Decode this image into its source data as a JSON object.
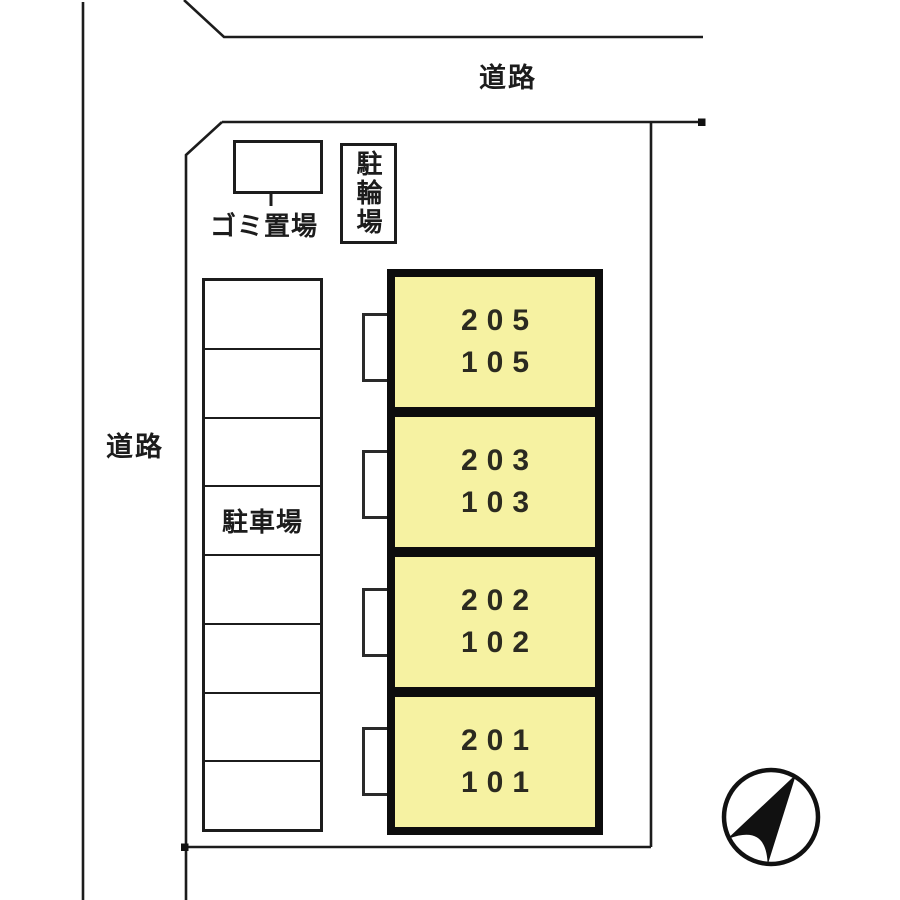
{
  "plan": {
    "road_top": {
      "label": "道路"
    },
    "road_left": {
      "label": "道路"
    },
    "garbage": {
      "label": "ゴミ置場"
    },
    "bicycle": {
      "label": "駐輪場"
    },
    "parking": {
      "label": "駐車場",
      "space_count": "8"
    },
    "building": {
      "fill_color": "#f6f2a2",
      "outline_color": "#0d0d0d",
      "units": [
        {
          "upper": "205",
          "lower": "105"
        },
        {
          "upper": "203",
          "lower": "103"
        },
        {
          "upper": "202",
          "lower": "102"
        },
        {
          "upper": "201",
          "lower": "101"
        }
      ]
    },
    "compass": {
      "icon": "north-arrow",
      "direction": "northeast"
    }
  }
}
